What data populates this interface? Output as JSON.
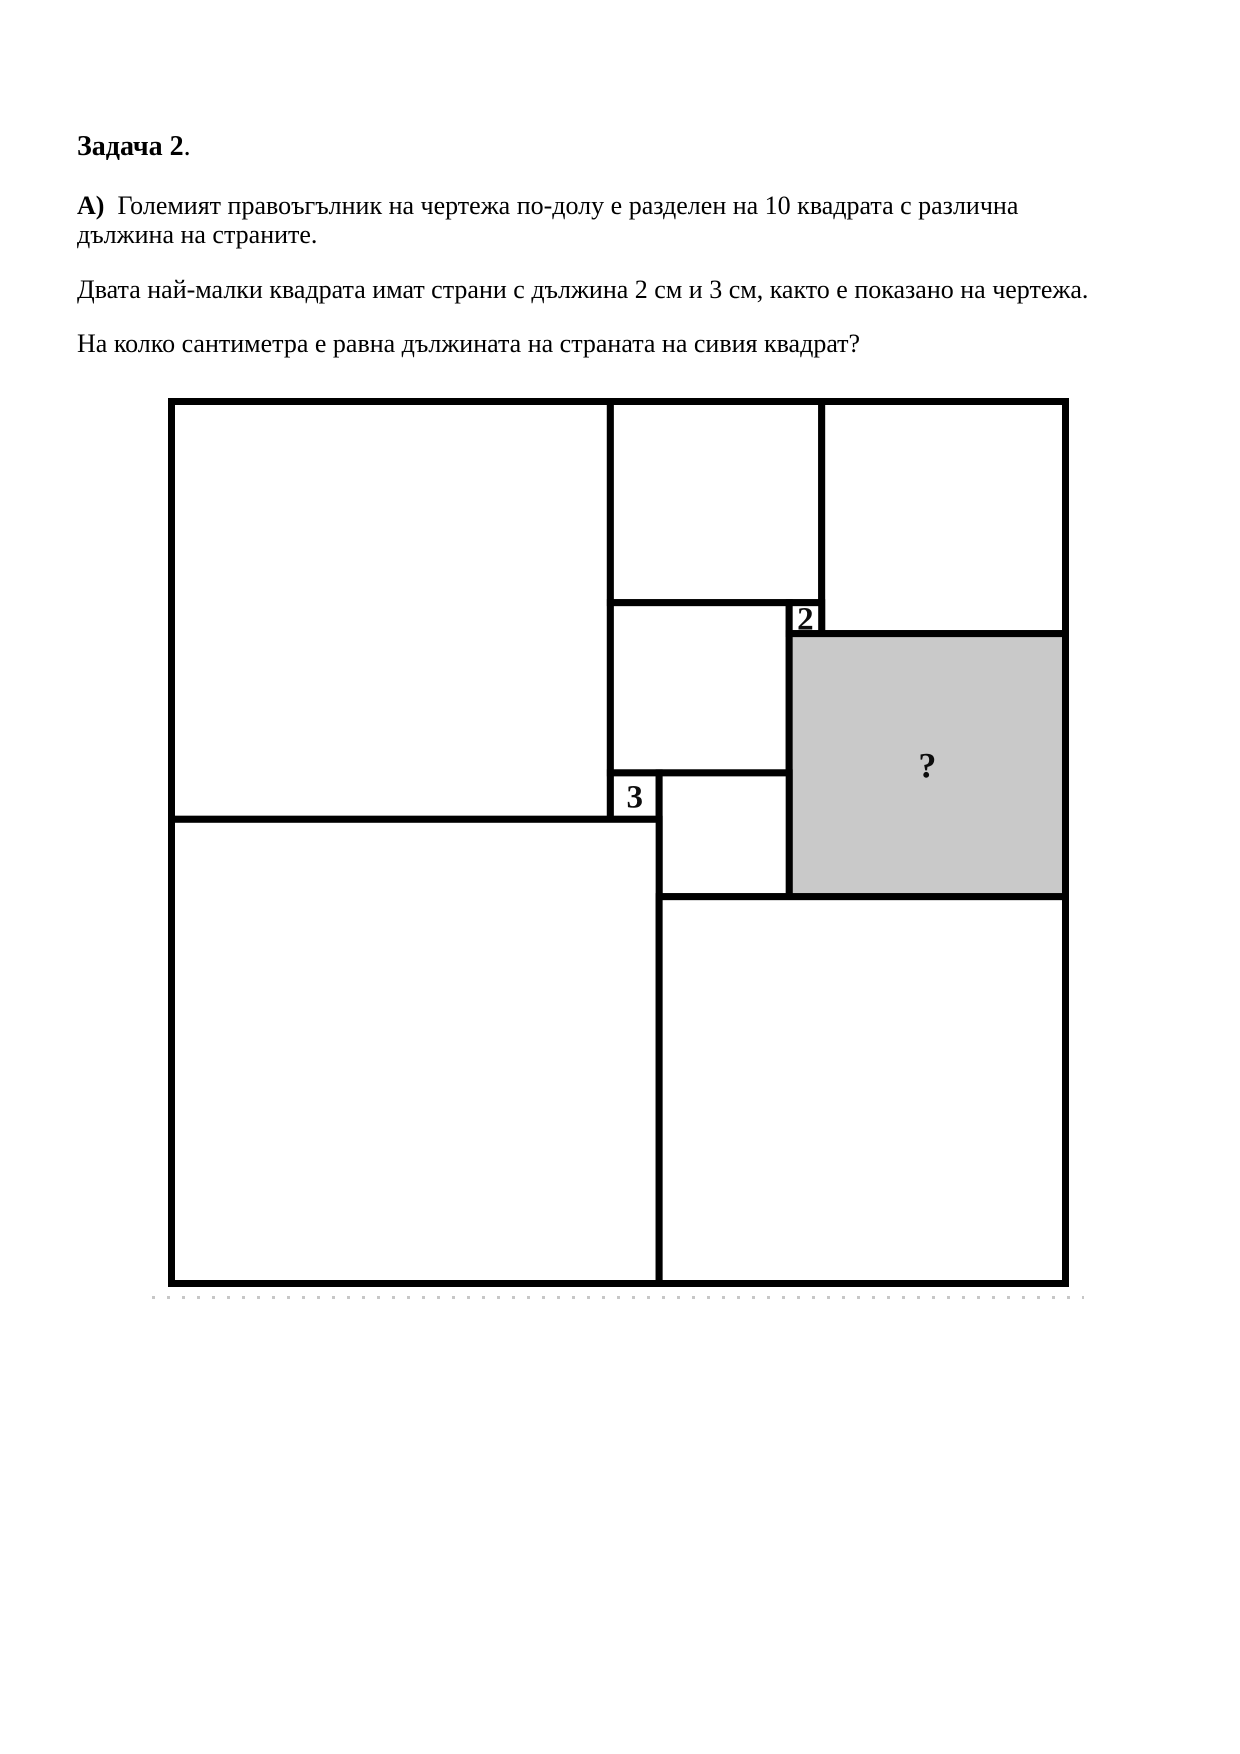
{
  "title": {
    "bold": "Задача 2",
    "tail": "."
  },
  "problem": {
    "part_label": "А)",
    "statement_line1": "Големият правоъгълник на чертежа по-долу е разделен на 10 квадрата с различна",
    "statement_line2": "дължина на страните.",
    "given": "Двата най-малки квадрата имат страни с дължина 2 см и 3 см, както е показано на чертежа.",
    "question": "На колко сантиметра е равна дължината на страната на сивия квадрат?"
  },
  "figure": {
    "unit_width": 55,
    "unit_height": 57,
    "frame_px": {
      "left": 171.5,
      "top": 401.5,
      "right": 1065.5,
      "bottom": 1283.5
    },
    "line_color": "#000000",
    "line_width": 7,
    "white_fill": "#ffffff",
    "gray_fill": "#c9c9c9",
    "squares": [
      {
        "id": "top-left",
        "x": 0,
        "y": 0,
        "s": 27,
        "shade": "white",
        "label": ""
      },
      {
        "id": "top-middle",
        "x": 27,
        "y": 0,
        "s": 13,
        "shade": "white",
        "label": ""
      },
      {
        "id": "top-right",
        "x": 40,
        "y": 0,
        "s": 15,
        "shade": "white",
        "label": ""
      },
      {
        "id": "middle",
        "x": 27,
        "y": 13,
        "s": 11,
        "shade": "white",
        "label": ""
      },
      {
        "id": "smallest-2",
        "x": 38,
        "y": 13,
        "s": 2,
        "shade": "white",
        "label": "2",
        "label_size": 33
      },
      {
        "id": "gray-square",
        "x": 38,
        "y": 15,
        "s": 17,
        "shade": "gray",
        "label": "?",
        "label_size": 36
      },
      {
        "id": "smallest-3",
        "x": 27,
        "y": 24,
        "s": 3,
        "shade": "white",
        "label": "3",
        "label_size": 33
      },
      {
        "id": "middle-small",
        "x": 30,
        "y": 24,
        "s": 8,
        "shade": "white",
        "label": ""
      },
      {
        "id": "bottom-left",
        "x": 0,
        "y": 27,
        "s": 30,
        "shade": "white",
        "label": ""
      },
      {
        "id": "bottom-right",
        "x": 30,
        "y": 32,
        "s": 25,
        "shade": "white",
        "label": ""
      }
    ]
  }
}
